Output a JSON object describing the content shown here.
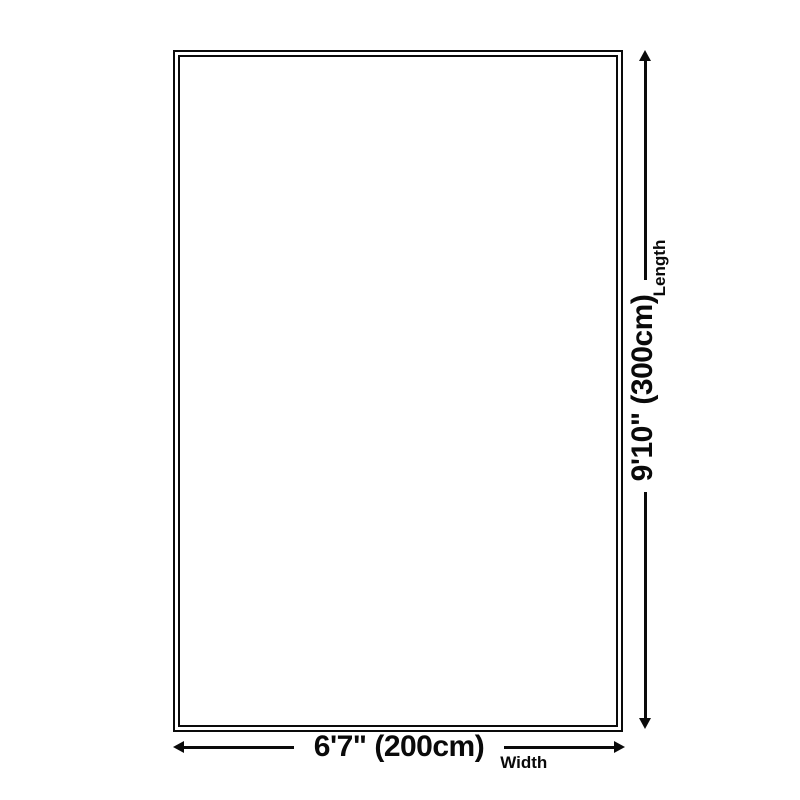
{
  "page": {
    "background_color": "#ffffff",
    "ink_color": "#0a0a0a",
    "description": "Rug size dimension diagram"
  },
  "diagram": {
    "width": {
      "value": "6'7\" (200cm)",
      "label": "Width"
    },
    "length": {
      "value": "9'10\" (300cm)",
      "label": "Length"
    }
  }
}
